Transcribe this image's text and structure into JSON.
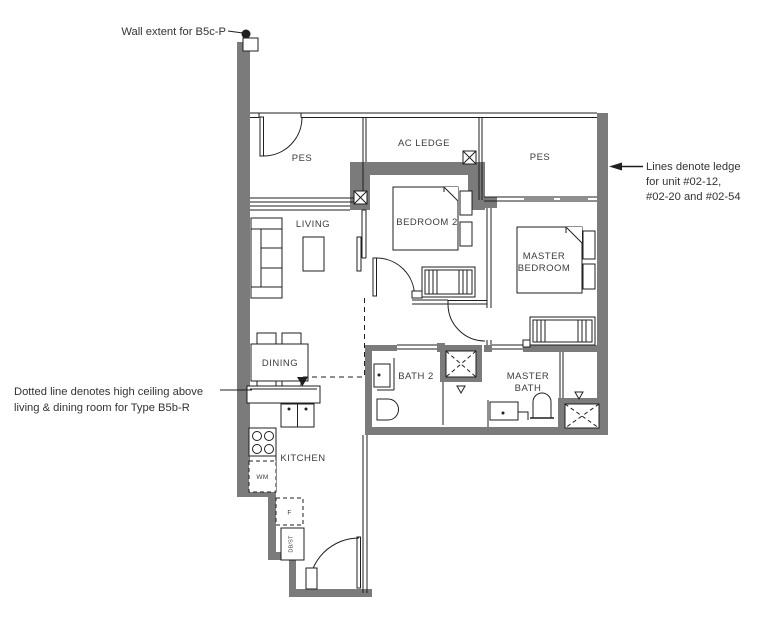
{
  "annotations": {
    "wall_extent": "Wall extent for B5c-P",
    "ledge": {
      "line1": "Lines denote ledge",
      "line2": "for unit #02-12,",
      "line3": "#02-20 and #02-54"
    },
    "ceiling": {
      "line1": "Dotted line denotes high ceiling above",
      "line2": "living & dining room for Type B5b-R"
    }
  },
  "rooms": {
    "pes_left": "PES",
    "ac_ledge": "AC LEDGE",
    "pes_right": "PES",
    "living": "LIVING",
    "bedroom2": "BEDROOM 2",
    "master_bedroom": {
      "line1": "MASTER",
      "line2": "BEDROOM"
    },
    "dining": "DINING",
    "bath2": "BATH 2",
    "master_bath": {
      "line1": "MASTER",
      "line2": "BATH"
    },
    "kitchen": "KITCHEN"
  },
  "appliances": {
    "washer": "WM",
    "fridge": "F",
    "db_st": "DB/ST"
  },
  "colors": {
    "wall": "#7b7b7b",
    "line": "#1f1f1f",
    "text": "#3c3c3c",
    "bg": "#ffffff"
  }
}
